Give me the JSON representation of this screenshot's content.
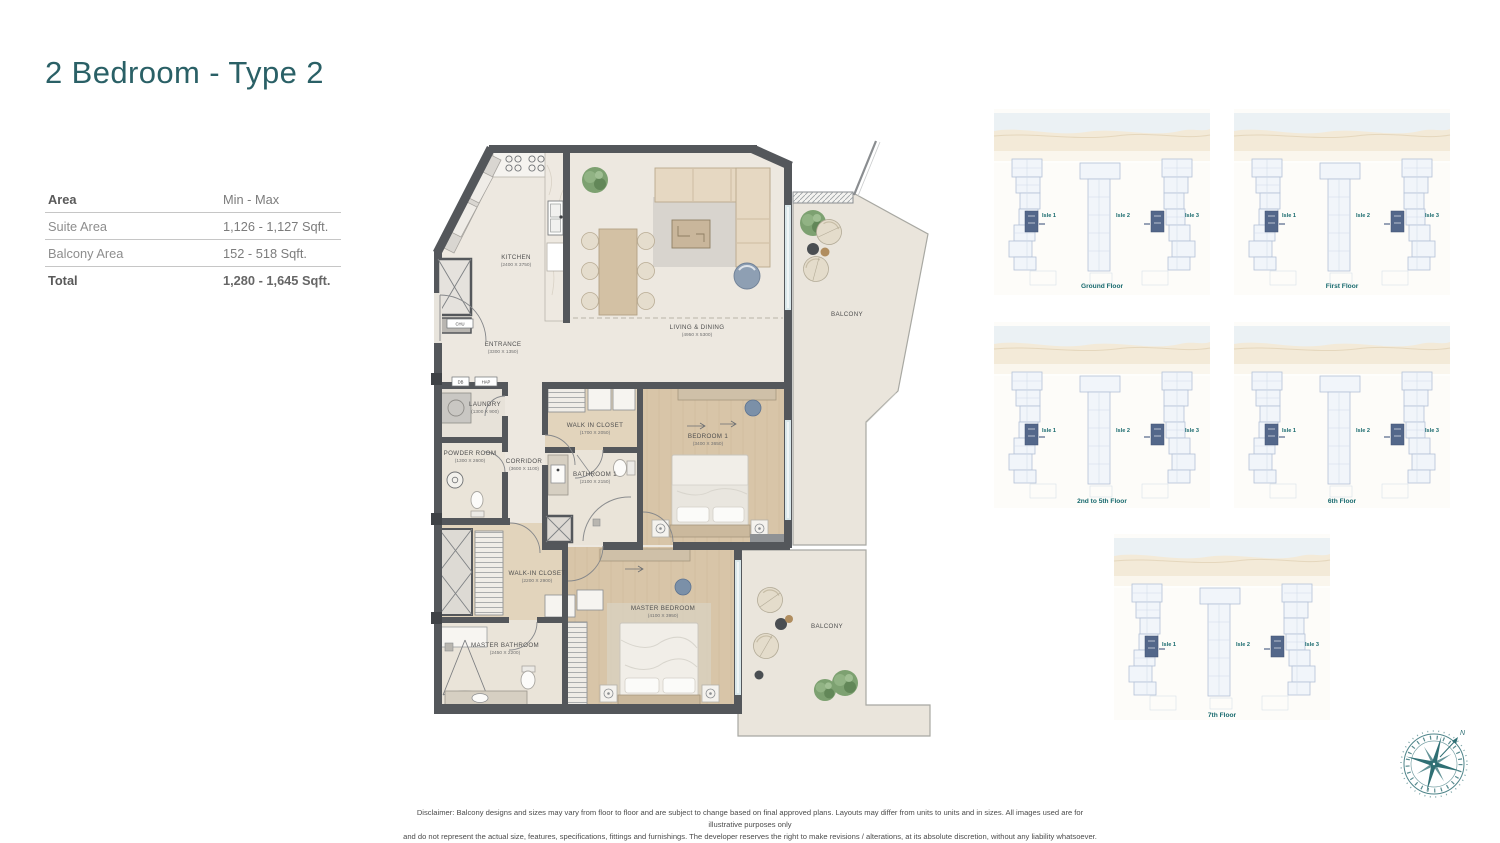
{
  "page": {
    "title": "2 Bedroom - Type 2"
  },
  "colors": {
    "accent_teal": "#2a6066",
    "keyplan_teal": "#17696d",
    "wall": "#54575b",
    "unit_highlight": "#53678a"
  },
  "area_table": {
    "header": {
      "label": "Area",
      "value": "Min - Max"
    },
    "rows": [
      {
        "label": "Suite Area",
        "value": "1,126 - 1,127 Sqft."
      },
      {
        "label": "Balcony Area",
        "value": "152 - 518 Sqft."
      }
    ],
    "total": {
      "label": "Total",
      "value": "1,280 - 1,645 Sqft."
    }
  },
  "floorplan": {
    "rooms": [
      {
        "name": "KITCHEN",
        "dims": "(2400 X 3750)",
        "x": 91,
        "y": 124
      },
      {
        "name": "ENTRANCE",
        "dims": "(3300 X 1350)",
        "x": 78,
        "y": 211
      },
      {
        "name": "LIVING & DINING",
        "dims": "(4950 X 5300)",
        "x": 272,
        "y": 194
      },
      {
        "name": "LAUNDRY",
        "dims": "(1300 X 900)",
        "x": 60,
        "y": 271
      },
      {
        "name": "POWDER ROOM",
        "dims": "(1300 X 2600)",
        "x": 45,
        "y": 320
      },
      {
        "name": "CORRIDOR",
        "dims": "(3600 X 1100)",
        "x": 99,
        "y": 328
      },
      {
        "name": "WALK IN CLOSET",
        "dims": "(1700 X 2050)",
        "x": 170,
        "y": 292
      },
      {
        "name": "BATHROOM 1",
        "dims": "(2100 X 2150)",
        "x": 170,
        "y": 341
      },
      {
        "name": "BEDROOM 1",
        "dims": "(3400 X 3650)",
        "x": 283,
        "y": 303
      },
      {
        "name": "WALK-IN CLOSET",
        "dims": "(2200 X 2900)",
        "x": 112,
        "y": 440
      },
      {
        "name": "MASTER BATHROOM",
        "dims": "(2450 X 2200)",
        "x": 80,
        "y": 512
      },
      {
        "name": "MASTER BEDROOM",
        "dims": "(4100 X 3950)",
        "x": 238,
        "y": 475
      },
      {
        "name": "BALCONY",
        "dims": "",
        "x": 422,
        "y": 181
      },
      {
        "name": "BALCONY",
        "dims": "",
        "x": 402,
        "y": 493
      }
    ],
    "wall_tags": [
      "CHU",
      "DB",
      "HAP"
    ]
  },
  "keyplans": [
    {
      "caption": "Ground Floor",
      "isles": [
        "Isle 1",
        "Isle 2",
        "Isle 3"
      ]
    },
    {
      "caption": "First Floor",
      "isles": [
        "Isle 1",
        "Isle 2",
        "Isle 3"
      ]
    },
    {
      "caption": "2nd to 5th Floor",
      "isles": [
        "Isle 1",
        "Isle 2",
        "Isle 3"
      ]
    },
    {
      "caption": "6th Floor",
      "isles": [
        "Isle 1",
        "Isle 2",
        "Isle 3"
      ]
    },
    {
      "caption": "7th Floor",
      "isles": [
        "Isle 1",
        "Isle 2",
        "Isle 3"
      ]
    }
  ],
  "compass": {
    "north_label": "N"
  },
  "disclaimer": {
    "line1": "Disclaimer: Balcony designs and sizes may vary from floor to floor and are subject to change based on final approved plans. Layouts may differ from units to units and in sizes. All images used are for illustrative purposes only",
    "line2": "and do not represent the actual size, features, specifications, fittings and furnishings. The developer reserves the right to make revisions / alterations, at its absolute discretion, without any liability whatsoever."
  }
}
